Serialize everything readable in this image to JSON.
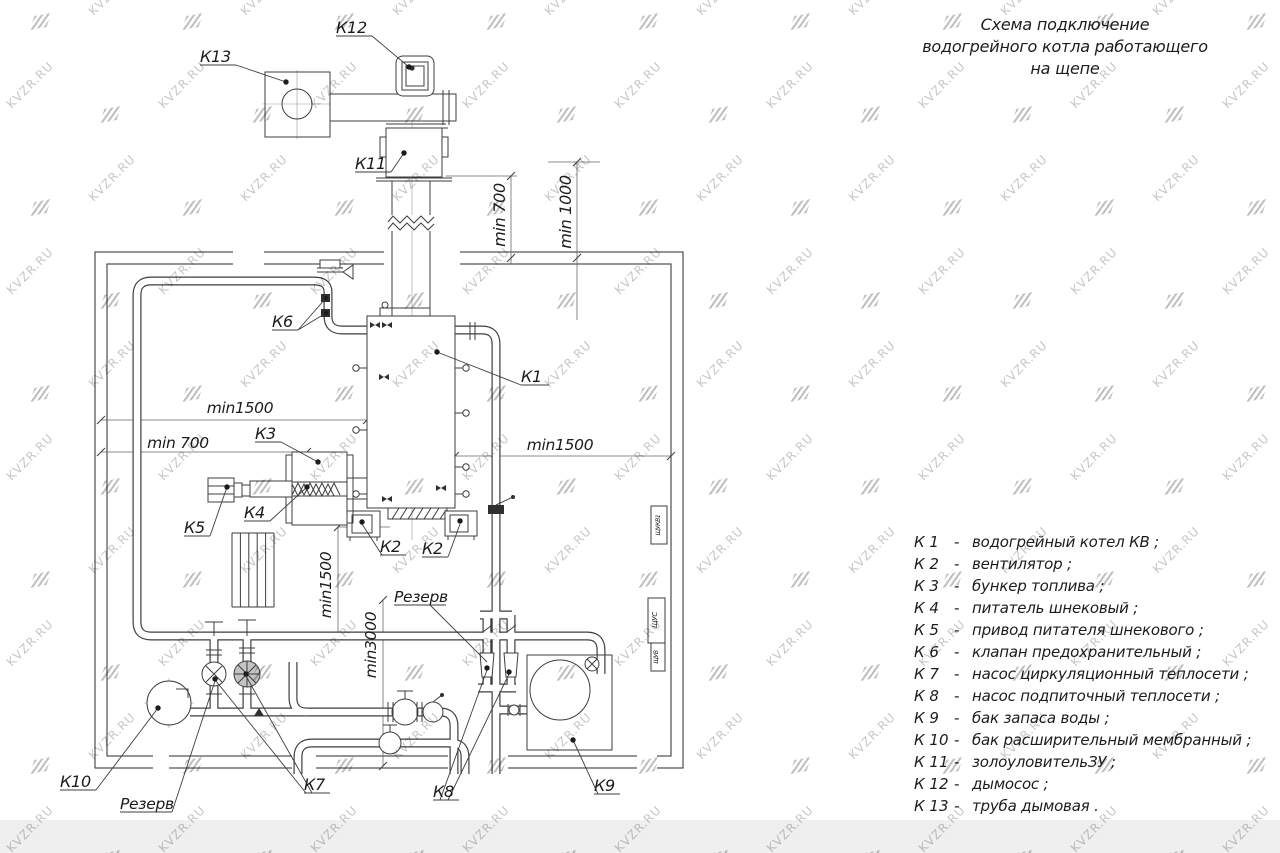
{
  "title": {
    "line1": "Схема подключение",
    "line2": "водогрейного котла работающего",
    "line3": "на щепе"
  },
  "legend": {
    "dash": "-",
    "items": [
      {
        "key": "К 1",
        "text": "водогрейный котел КВ ;"
      },
      {
        "key": "К 2",
        "text": "вентилятор ;"
      },
      {
        "key": "К 3",
        "text": "бункер топлива ;"
      },
      {
        "key": "К 4",
        "text": "питатель шнековый ;"
      },
      {
        "key": "К 5",
        "text": "привод питателя шнекового ;"
      },
      {
        "key": "К 6",
        "text": "клапан предохранительный ;"
      },
      {
        "key": "К 7",
        "text": "насос циркуляционный теплосети ;"
      },
      {
        "key": "К 8",
        "text": "насос подпиточный теплосети ;"
      },
      {
        "key": "К 9",
        "text": "бак запаса воды ;"
      },
      {
        "key": "К 10",
        "text": "бак расширительный мембранный ;"
      },
      {
        "key": "К 11",
        "text": "золоуловительЗУ ;"
      },
      {
        "key": "К 12",
        "text": "дымосос ;"
      },
      {
        "key": "К 13",
        "text": "труба дымовая ."
      }
    ]
  },
  "watermark": {
    "text": "KVZR.RU"
  },
  "colors": {
    "line": "#3d3d3d",
    "dim_line": "#6a6a6a",
    "label_text": "#1c1c1c",
    "watermark_text": "#c7c7c7",
    "watermark_logo": "#bfbfbf",
    "bottom_band": "#efefef"
  },
  "diagram_labels": [
    {
      "n": "label-k13",
      "t": "К13",
      "x": 200,
      "y": 62,
      "r": 0,
      "a": "start",
      "s": 16,
      "w": 36
    },
    {
      "n": "label-k12",
      "t": "К12",
      "x": 336,
      "y": 33,
      "r": 0,
      "a": "start",
      "s": 16,
      "w": 36
    },
    {
      "n": "label-k11",
      "t": "К11",
      "x": 355,
      "y": 169,
      "r": 0,
      "a": "start",
      "s": 16,
      "w": 36
    },
    {
      "n": "label-k1",
      "t": "К1",
      "x": 521,
      "y": 382,
      "r": 0,
      "a": "start",
      "s": 16,
      "w": 28
    },
    {
      "n": "label-k6",
      "t": "К6",
      "x": 272,
      "y": 327,
      "r": 0,
      "a": "start",
      "s": 16,
      "w": 26
    },
    {
      "n": "label-k3",
      "t": "К3",
      "x": 255,
      "y": 439,
      "r": 0,
      "a": "start",
      "s": 16,
      "w": 26
    },
    {
      "n": "label-k4",
      "t": "К4",
      "x": 244,
      "y": 518,
      "r": 0,
      "a": "start",
      "s": 16,
      "w": 26
    },
    {
      "n": "label-k5",
      "t": "К5",
      "x": 184,
      "y": 533,
      "r": 0,
      "a": "start",
      "s": 16,
      "w": 26
    },
    {
      "n": "label-k2-left",
      "t": "К2",
      "x": 380,
      "y": 552,
      "r": 0,
      "a": "start",
      "s": 16,
      "w": 26
    },
    {
      "n": "label-k2-right",
      "t": "К2",
      "x": 422,
      "y": 554,
      "r": 0,
      "a": "start",
      "s": 16,
      "w": 26
    },
    {
      "n": "label-k10",
      "t": "К10",
      "x": 60,
      "y": 787,
      "r": 0,
      "a": "start",
      "s": 16,
      "w": 36
    },
    {
      "n": "label-reserve-left",
      "t": "Резерв",
      "x": 120,
      "y": 809,
      "r": 0,
      "a": "start",
      "s": 15.5,
      "w": 52
    },
    {
      "n": "label-k7",
      "t": "К7",
      "x": 304,
      "y": 790,
      "r": 0,
      "a": "start",
      "s": 16,
      "w": 26
    },
    {
      "n": "label-k8",
      "t": "К8",
      "x": 433,
      "y": 797,
      "r": 0,
      "a": "start",
      "s": 16,
      "w": 26
    },
    {
      "n": "label-reserve-right",
      "t": "Резерв",
      "x": 394,
      "y": 602,
      "r": 0,
      "a": "start",
      "s": 15.5,
      "w": 52
    },
    {
      "n": "label-k9",
      "t": "К9",
      "x": 594,
      "y": 791,
      "r": 0,
      "a": "start",
      "s": 16,
      "w": 26
    },
    {
      "n": "dim-min1500-left",
      "t": "min1500",
      "x": 240,
      "y": 413,
      "r": 0,
      "a": "middle",
      "s": 15.5,
      "w": 0
    },
    {
      "n": "dim-min700-left",
      "t": "min 700",
      "x": 178,
      "y": 448,
      "r": 0,
      "a": "middle",
      "s": 15.5,
      "w": 0
    },
    {
      "n": "dim-min1500-right",
      "t": "min1500",
      "x": 560,
      "y": 450,
      "r": 0,
      "a": "middle",
      "s": 15.5,
      "w": 0
    },
    {
      "n": "dim-min1500-vertical",
      "t": "min1500",
      "x": 331,
      "y": 585,
      "r": -90,
      "a": "middle",
      "s": 15.5,
      "w": 0
    },
    {
      "n": "dim-min3000-vertical",
      "t": "min3000",
      "x": 376,
      "y": 645,
      "r": -90,
      "a": "middle",
      "s": 15.5,
      "w": 0
    },
    {
      "n": "dim-min700-top",
      "t": "min 700",
      "x": 505,
      "y": 215,
      "r": -90,
      "a": "middle",
      "s": 16,
      "w": 0
    },
    {
      "n": "dim-min1000-top",
      "t": "min 1000",
      "x": 571,
      "y": 212,
      "r": -90,
      "a": "middle",
      "s": 16,
      "w": 0
    },
    {
      "n": "cabinet-label-schukv1",
      "t": "ЩУКВ1",
      "x": 660,
      "y": 525,
      "r": -90,
      "a": "middle",
      "s": 6,
      "w": 0
    },
    {
      "n": "cabinet-label-schus",
      "t": "ЩУС",
      "x": 657,
      "y": 620,
      "r": -90,
      "a": "middle",
      "s": 7,
      "w": 0
    },
    {
      "n": "cabinet-label-schuv",
      "t": "ЩУВ",
      "x": 658,
      "y": 657,
      "r": -90,
      "a": "middle",
      "s": 6,
      "w": 0
    }
  ]
}
